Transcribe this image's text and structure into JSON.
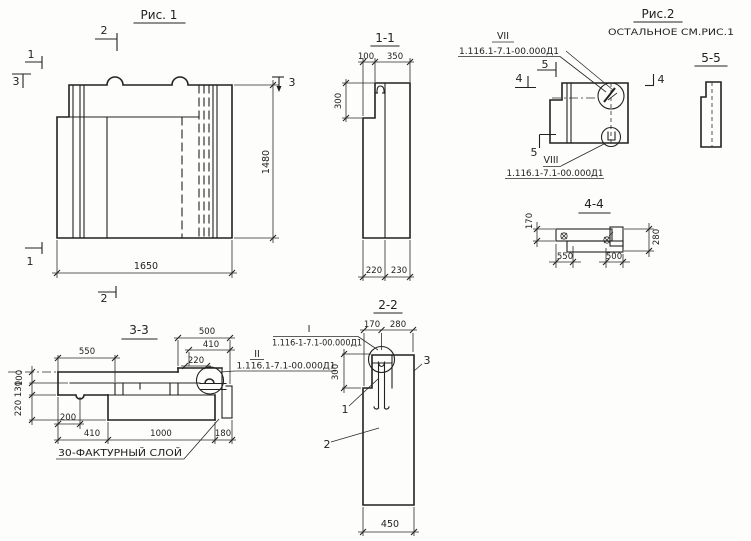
{
  "figure1": {
    "title": "Рис. 1",
    "dim_width": "1650",
    "dim_height": "1480",
    "mark1": "1",
    "mark2": "2",
    "mark3": "3"
  },
  "section_1_1": {
    "title": "1-1",
    "dim_100": "100",
    "dim_350": "350",
    "dim_300": "300",
    "dim_220": "220",
    "dim_230": "230"
  },
  "figure2": {
    "title": "Рис.2",
    "subtitle": "ОСТАЛЬНОЕ СМ.РИС.1",
    "mark4": "4",
    "mark5": "5",
    "detail_vii": {
      "label": "VII",
      "ref": "1.116.1-7.1-00.000Д1"
    },
    "detail_viii": {
      "label": "VIII",
      "ref": "1.116.1-7.1-00.000Д1"
    }
  },
  "section_5_5": {
    "title": "5-5"
  },
  "section_4_4": {
    "title": "4-4",
    "dim_170": "170",
    "dim_280": "280",
    "dim_550": "550",
    "dim_500": "500"
  },
  "section_3_3": {
    "title": "3-3",
    "dim_550": "550",
    "dim_500": "500",
    "dim_410_top": "410",
    "dim_220_top": "220",
    "dim_100": "100",
    "dim_130": "130",
    "dim_220_left": "220",
    "dim_200": "200",
    "dim_410_bottom": "410",
    "dim_1000": "1000",
    "dim_180": "180",
    "note": "30-ФАКТУРНЫЙ СЛОЙ",
    "detail_ii": {
      "label": "II",
      "ref": "1.116.1-7.1-00.000Д1"
    }
  },
  "section_2_2": {
    "title": "2-2",
    "dim_170": "170",
    "dim_280": "280",
    "dim_300": "300",
    "dim_450": "450",
    "detail_i": {
      "label": "I",
      "ref": "1.116-1-7.1-00.000Д1"
    },
    "leader_1": "1",
    "leader_2": "2",
    "leader_3": "3"
  }
}
